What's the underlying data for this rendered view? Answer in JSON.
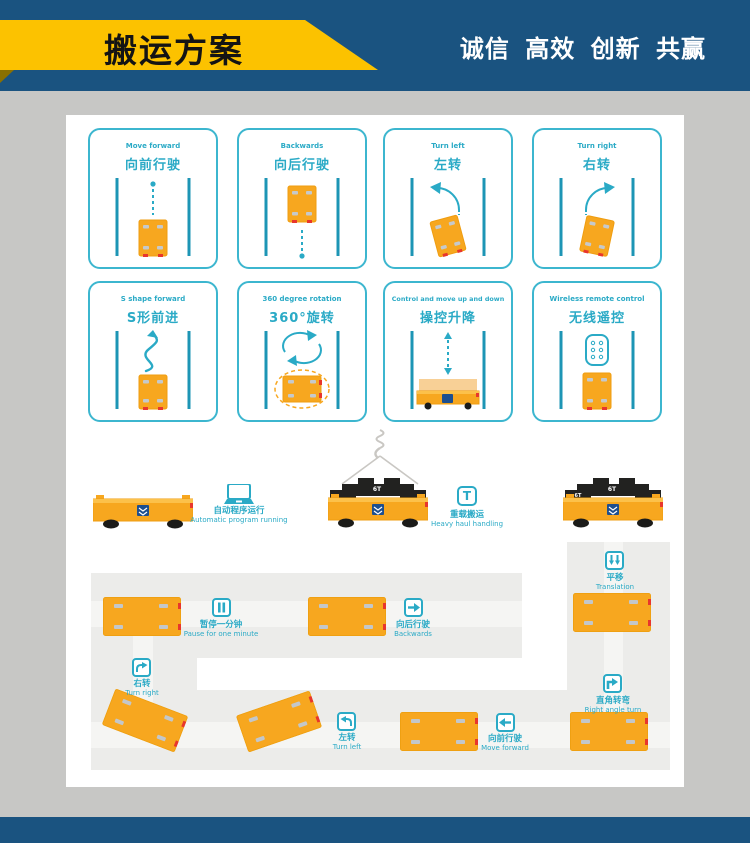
{
  "header": {
    "title": "搬运方案",
    "slogan": "诚信 高效 创新 共赢"
  },
  "colors": {
    "navy": "#1a5380",
    "yellow": "#fcc200",
    "teal": "#2aaac6",
    "orange": "#f7a71f",
    "red": "#e8362c"
  },
  "cards": [
    {
      "en": "Move forward",
      "zh": "向前行驶"
    },
    {
      "en": "Backwards",
      "zh": "向后行驶"
    },
    {
      "en": "Turn left",
      "zh": "左转"
    },
    {
      "en": "Turn right",
      "zh": "右转"
    },
    {
      "en": "S shape forward",
      "zh": "S形前进"
    },
    {
      "en": "360 degree rotation",
      "zh": "360°旋转"
    },
    {
      "en": "Control and move up and down",
      "zh": "操控升降"
    },
    {
      "en": "Wireless remote control",
      "zh": "无线遥控"
    }
  ],
  "middle": {
    "auto": {
      "zh": "自动程序运行",
      "en": "Automatic program running"
    },
    "heavy": {
      "zh": "重载搬运",
      "en": "Heavy haul handling",
      "badge": "T"
    },
    "load_label": "6T"
  },
  "map": {
    "pause": {
      "zh": "暂停一分钟",
      "en": "Pause for one minute"
    },
    "backwards": {
      "zh": "向后行驶",
      "en": "Backwards"
    },
    "translation": {
      "zh": "平移",
      "en": "Translation"
    },
    "turn_right": {
      "zh": "右转",
      "en": "Turn right"
    },
    "right_angle": {
      "zh": "直角转弯",
      "en": "Right angle turn"
    },
    "turn_left": {
      "zh": "左转",
      "en": "Turn left"
    },
    "forward": {
      "zh": "向前行驶",
      "en": "Move forward"
    }
  }
}
